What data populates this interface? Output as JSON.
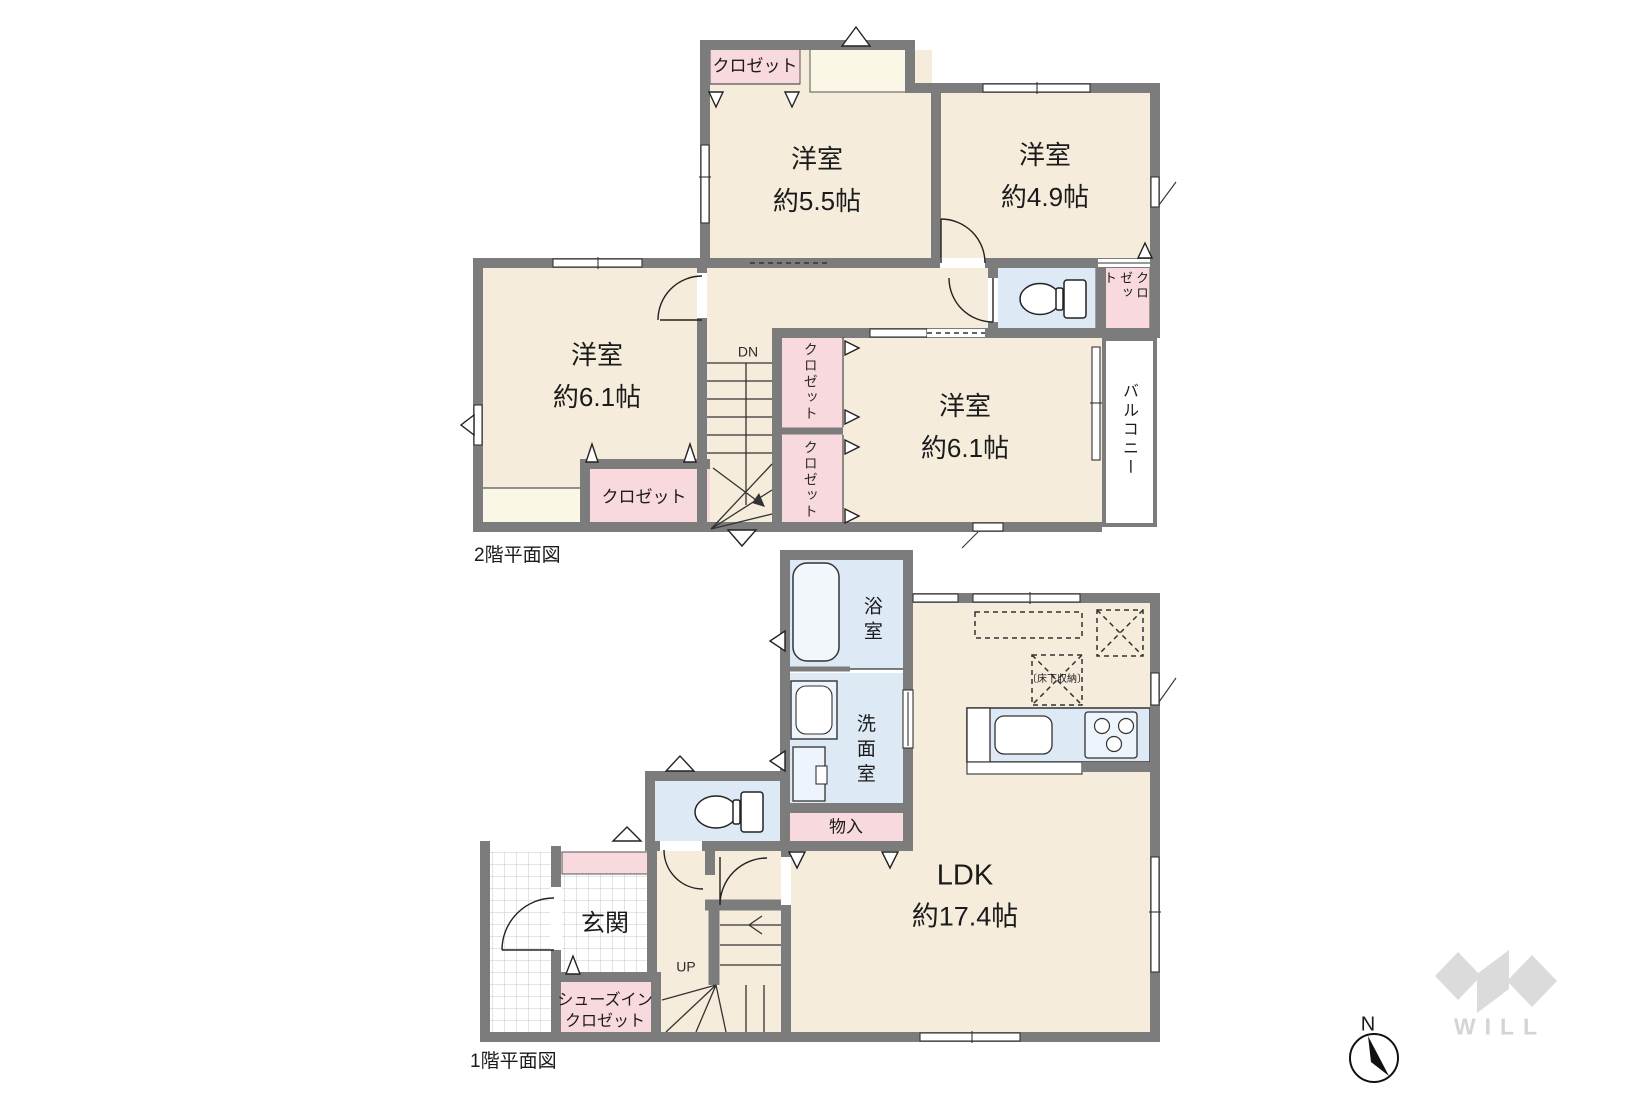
{
  "floor2": {
    "title": "2階平面図",
    "labels": {
      "closet": "クロゼット",
      "balcony": "バルコニー",
      "dn": "DN",
      "room_a_name": "洋室",
      "room_a_size": "約5.5帖",
      "room_b_name": "洋室",
      "room_b_size": "約4.9帖",
      "room_c_name": "洋室",
      "room_c_size": "約6.1帖",
      "room_d_name": "洋室",
      "room_d_size": "約6.1帖"
    }
  },
  "floor1": {
    "title": "1階平面図",
    "labels": {
      "bath": "浴室",
      "washroom": "洗面室",
      "storage": "物入",
      "underfloor_storage": "〔床下収納〕",
      "ldk_name": "LDK",
      "ldk_size": "約17.4帖",
      "up": "UP",
      "entrance": "玄関",
      "shoe_closet_line1": "シューズイン",
      "shoe_closet_line2": "クロゼット"
    }
  },
  "compass": {
    "north": "N"
  },
  "watermark": {
    "brand": "WILL"
  },
  "colors": {
    "wall": "#7c7c7c",
    "floor_cream": "#f5ecdc",
    "closet_pink": "#f8d9de",
    "wet_area_blue": "#dde9f4",
    "pale_cream": "#fbf7e6",
    "watermark_gray": "#d7d7d7"
  }
}
